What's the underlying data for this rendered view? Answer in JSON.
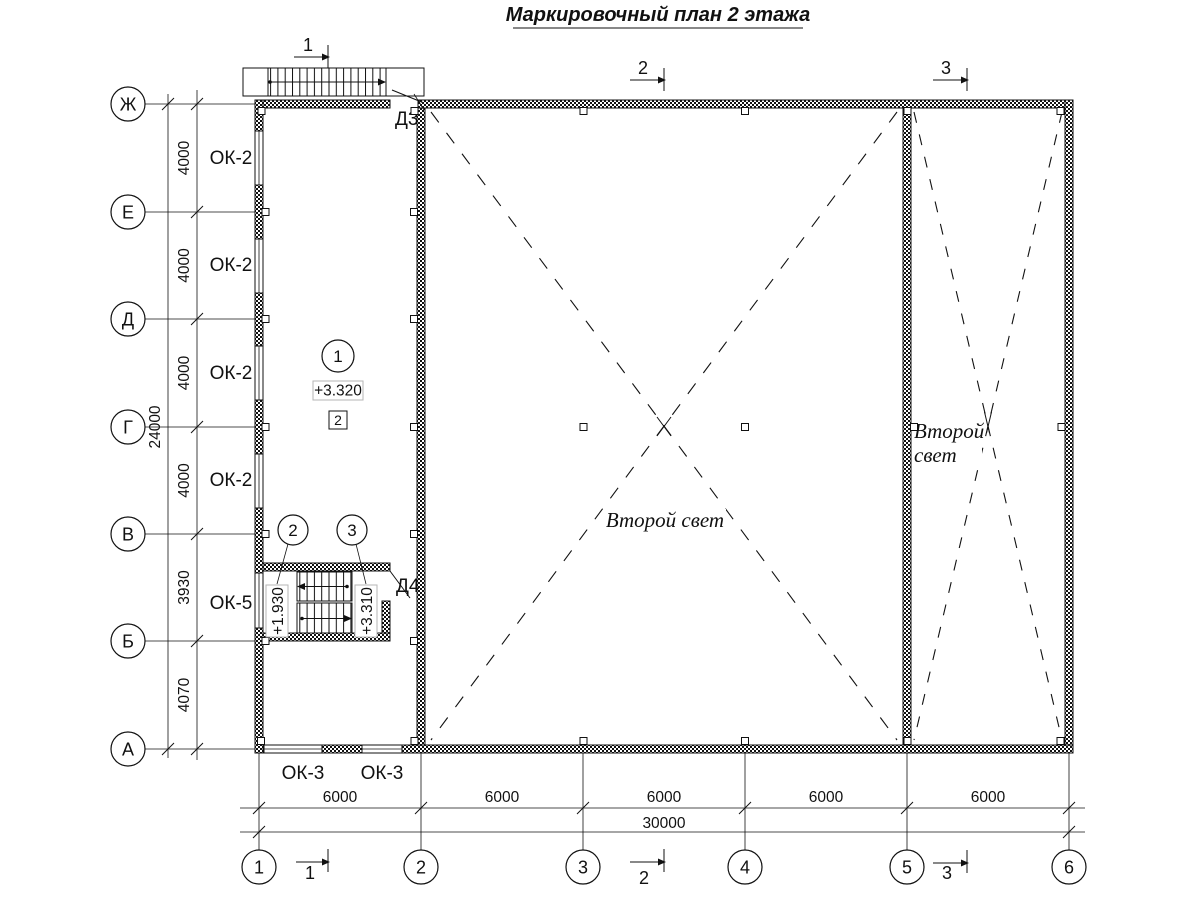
{
  "colors": {
    "ink": "#111111",
    "paper": "#ffffff"
  },
  "title": "Маркировочный план 2 этажа",
  "axes": {
    "vertical": [
      "Ж",
      "Е",
      "Д",
      "Г",
      "В",
      "Б",
      "А"
    ],
    "horizontal": [
      "1",
      "2",
      "3",
      "4",
      "5",
      "6"
    ]
  },
  "dims": {
    "left": [
      "4000",
      "4000",
      "4000",
      "4000",
      "3930",
      "4070"
    ],
    "left_total": "24000",
    "bottom": [
      "6000",
      "6000",
      "6000",
      "6000",
      "6000"
    ],
    "bottom_total": "30000"
  },
  "sections": [
    "1",
    "2",
    "3"
  ],
  "windows": {
    "ok2": "ОК-2",
    "ok5": "ОК-5",
    "ok3": "ОК-3"
  },
  "doors": {
    "d3": "Д3",
    "d4": "Д4"
  },
  "marks": {
    "room_number": "1",
    "finish_mark": "2",
    "node_left": "2",
    "node_right": "3"
  },
  "elevations": {
    "floor": "+3.320",
    "landing": "+1.930",
    "upper": "+3.310"
  },
  "second_light": {
    "single": "Второй свет",
    "line1": "Второй",
    "line2": "свет"
  }
}
